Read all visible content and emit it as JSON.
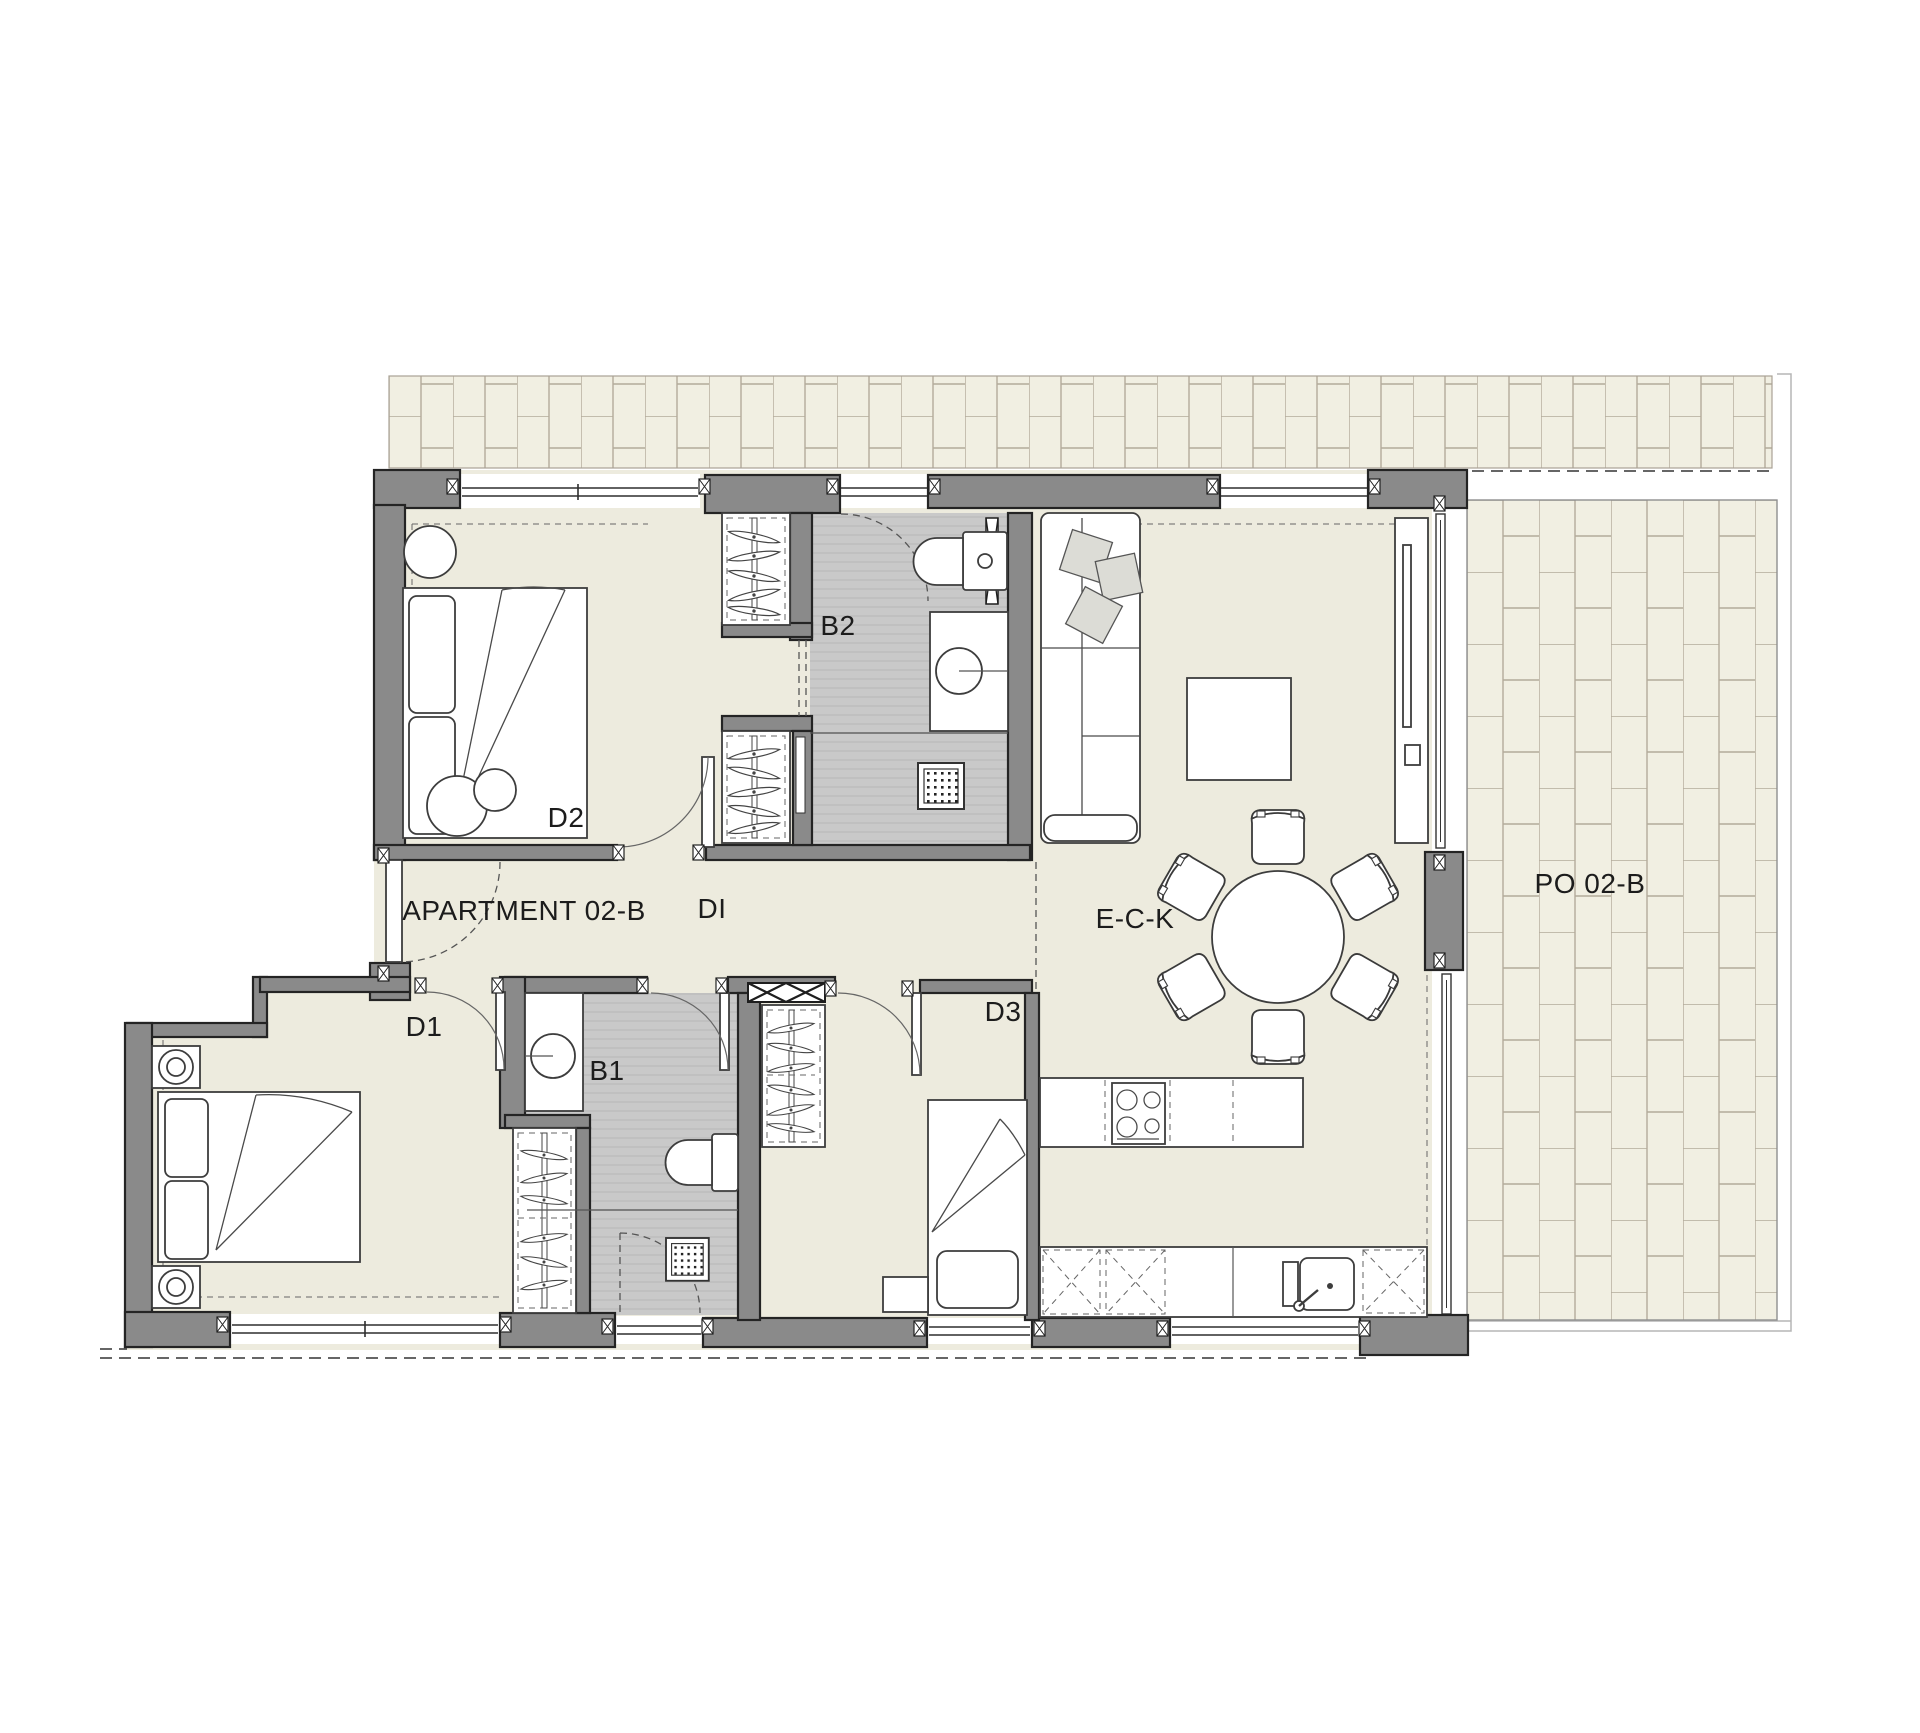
{
  "plan": {
    "title_label": "APARTMENT 02-B",
    "rooms": {
      "hallway": "DI",
      "bedroom1": "D1",
      "bedroom2": "D2",
      "bedroom3": "D3",
      "bathroom1": "B1",
      "bathroom2": "B2",
      "living_dining_kitchen": "E-C-K",
      "porch": "PO 02-B"
    },
    "colors": {
      "wall": "#8a8a8a",
      "floor": "#edebde",
      "bathroom_floor": "#c9c9c9",
      "tile": "#f1efe2",
      "tile_joint": "#b3ab9b",
      "line": "#2e2e2e"
    }
  }
}
